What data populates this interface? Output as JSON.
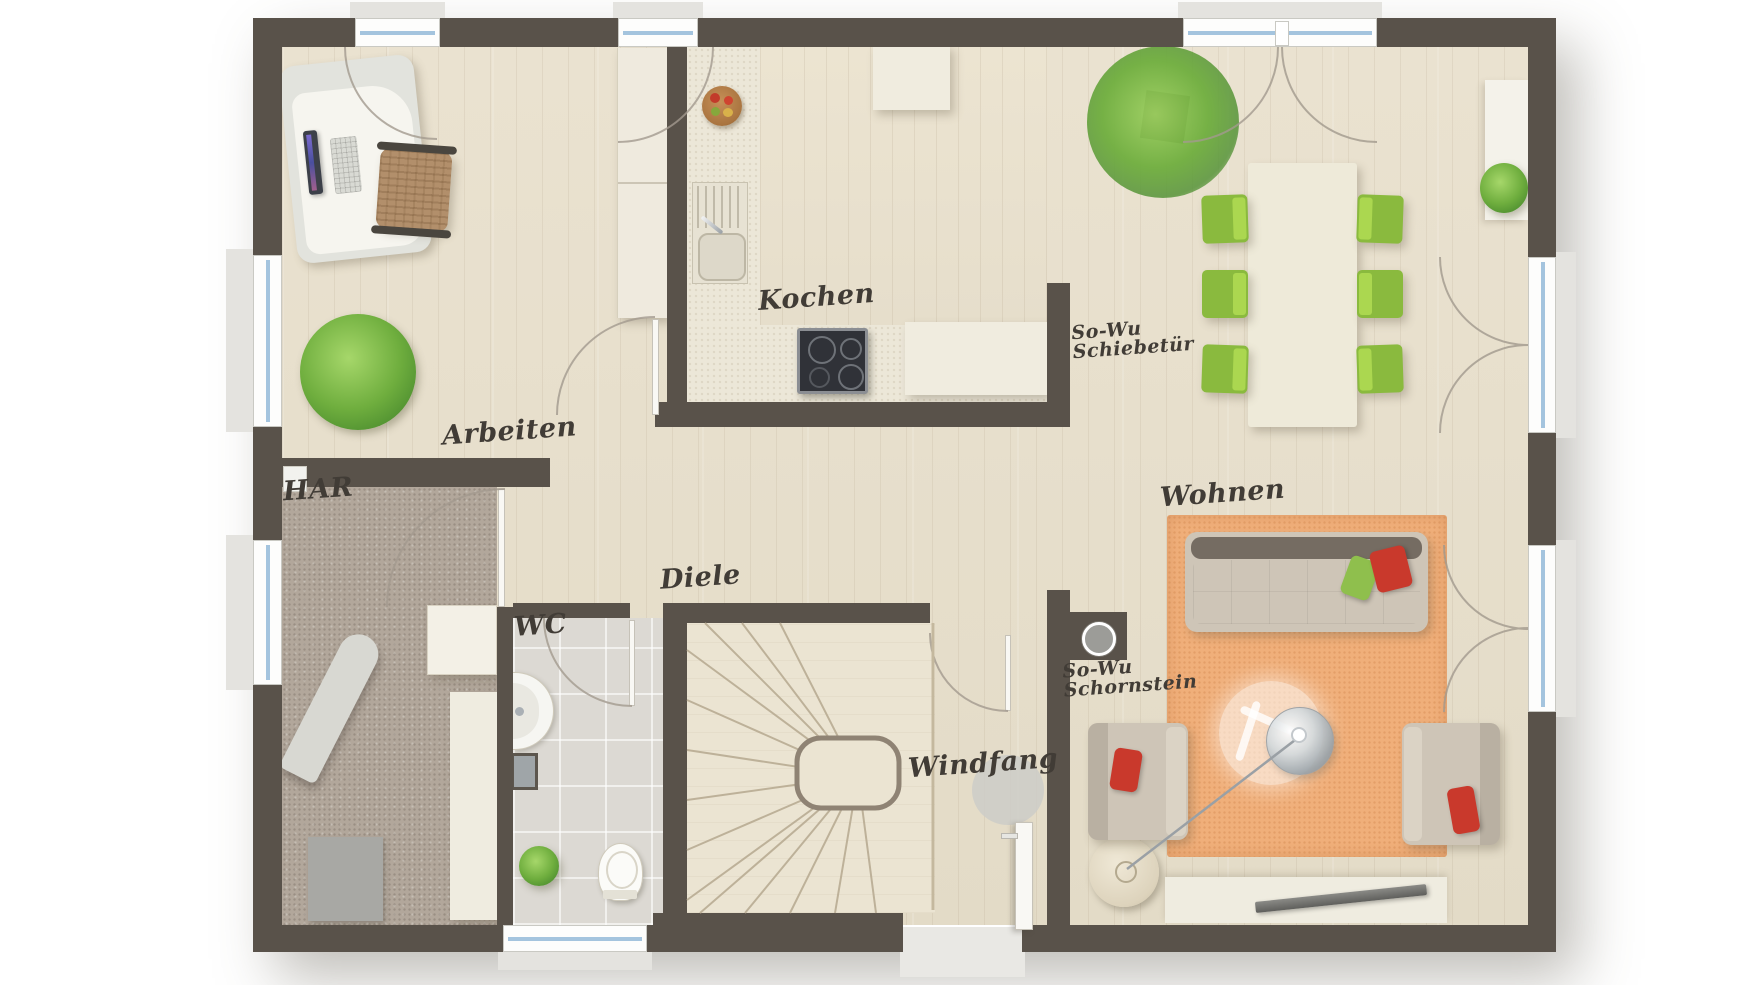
{
  "rooms": {
    "kochen": {
      "label": "Kochen"
    },
    "arbeiten": {
      "label": "Arbeiten"
    },
    "har": {
      "label": "HAR"
    },
    "wc": {
      "label": "WC"
    },
    "diele": {
      "label": "Diele"
    },
    "windfang": {
      "label": "Windfang"
    },
    "wohnen": {
      "label": "Wohnen"
    }
  },
  "annotations": {
    "schiebetuer": {
      "line1": "So-Wu",
      "line2": "Schiebetür"
    },
    "schornstein": {
      "line1": "So-Wu",
      "line2": "Schornstein"
    }
  },
  "colors": {
    "wall": "#59524a",
    "floor_wood": "#e7dfcd",
    "floor_kitchen": "#ebe6d9",
    "floor_har": "#b2a79b",
    "floor_wc": "#dcd9d3",
    "floor_stairs": "#ebe4d2",
    "rug_orange": "#f0af7a",
    "chair_green": "#8aba3e",
    "chair_green_light": "#abd750",
    "sofa_beige": "#cec5b7",
    "sofa_back": "#756c62",
    "pillow_red": "#c9392c",
    "pillow_green": "#8fbf4d",
    "counter_white": "#f0ecdf",
    "cooktop_dark": "#303238",
    "glass_blue": "#a4c4de",
    "sill_gray": "#e4e3df",
    "label_ink": "#413c36",
    "plant_green": "#6fae3e",
    "bowl_brown": "#a9743f"
  }
}
